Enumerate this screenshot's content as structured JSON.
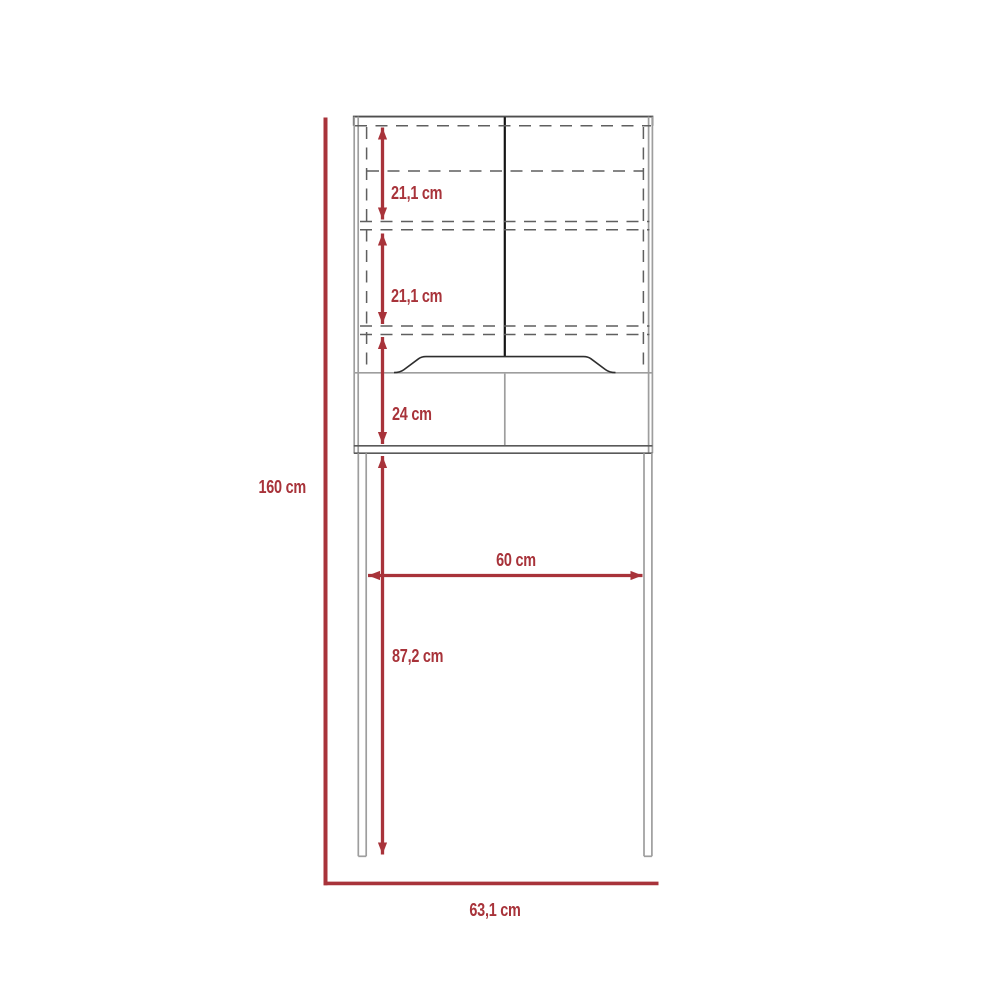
{
  "diagram": {
    "kind": "furniture-dimension-diagram",
    "subject": "over-toilet space-saver cabinet, front elevation",
    "unit": "cm",
    "labels": {
      "shelf_gap_top": "21,1 cm",
      "shelf_gap_middle": "21,1 cm",
      "open_compartment_height": "24 cm",
      "inner_clearance_width": "60 cm",
      "under_clearance_height": "87,2 cm",
      "overall_height": "160 cm",
      "overall_width": "63,1 cm"
    },
    "colors": {
      "dimension_red": "#a8333a",
      "outline_gray": "#9e9e9e",
      "outline_dark_gray": "#4f4f4f",
      "hidden_line_gray": "#5f5f5f",
      "door_divider_black": "#141414",
      "background": "#ffffff"
    }
  }
}
